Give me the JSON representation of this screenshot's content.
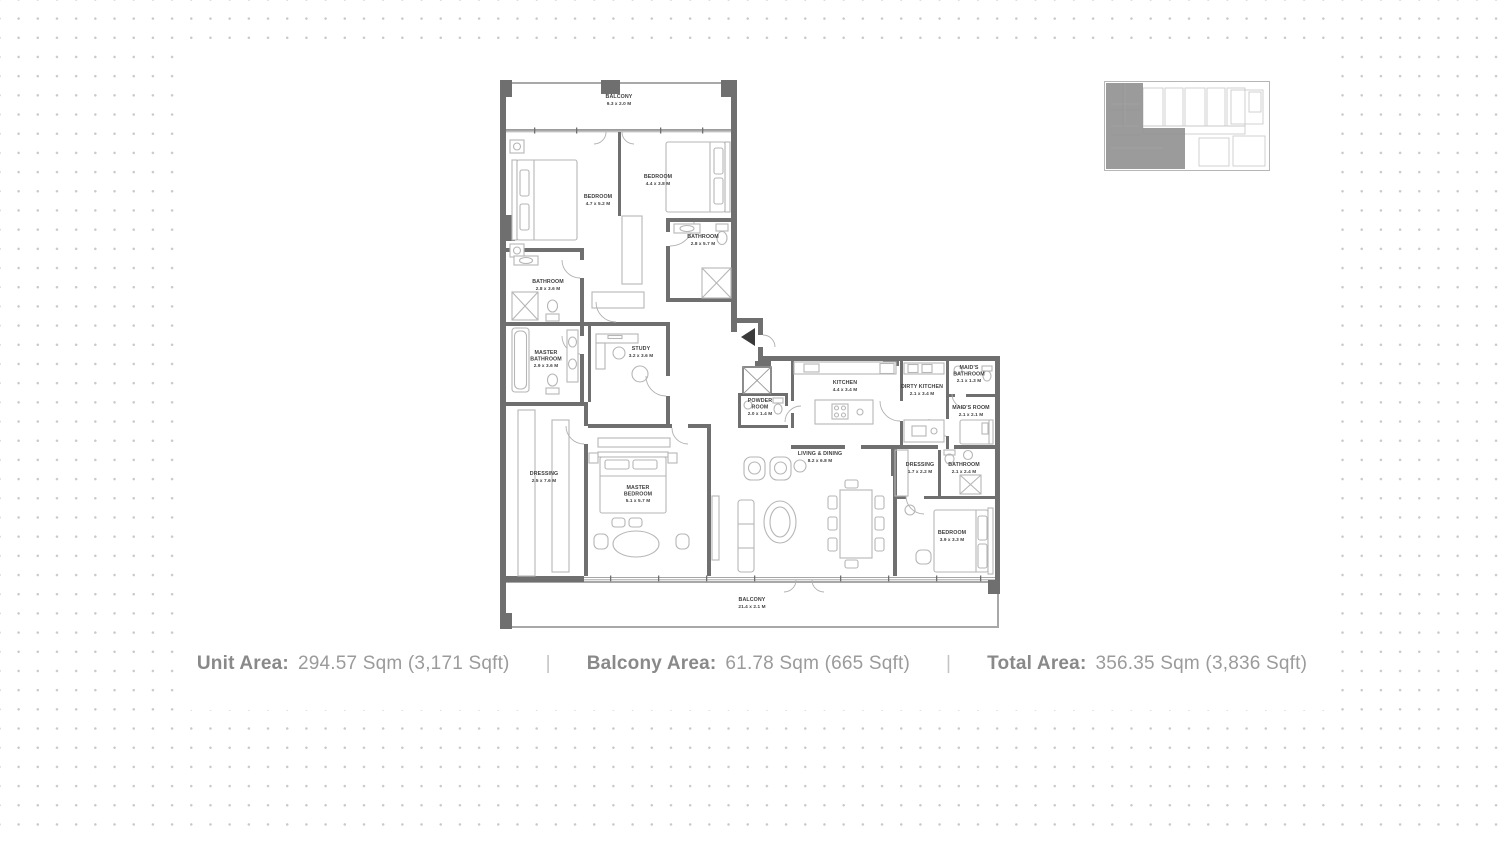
{
  "footer": {
    "separator": "|",
    "items": [
      {
        "label": "Unit Area:",
        "value": "294.57 Sqm (3,171 Sqft)"
      },
      {
        "label": "Balcony Area:",
        "value": "61.78 Sqm (665 Sqft)"
      },
      {
        "label": "Total Area:",
        "value": "356.35 Sqm (3,836 Sqft)"
      }
    ]
  },
  "plan": {
    "rooms": {
      "balcony_top": {
        "lines": [
          "BALCONY",
          "9.3 x 2.0 M"
        ]
      },
      "bedroom_1": {
        "lines": [
          "BEDROOM",
          "4.7 x 5.2 M"
        ]
      },
      "bedroom_2": {
        "lines": [
          "BEDROOM",
          "4.4 x 3.8 M"
        ]
      },
      "bathroom_2": {
        "lines": [
          "BATHROOM",
          "2.8 x 5.7 M"
        ]
      },
      "bathroom_1": {
        "lines": [
          "BATHROOM",
          "2.8 x 3.6 M"
        ]
      },
      "master_bathroom": {
        "lines": [
          "MASTER",
          "BATHROOM",
          "2.9 x 3.6 M"
        ]
      },
      "study": {
        "lines": [
          "STUDY",
          "3.2 x 3.6 M"
        ]
      },
      "powder_room": {
        "lines": [
          "POWDER",
          "ROOM",
          "2.0 x 1.4 M"
        ]
      },
      "kitchen": {
        "lines": [
          "KITCHEN",
          "4.4 x 3.4 M"
        ]
      },
      "dirty_kitchen": {
        "lines": [
          "DIRTY KITCHEN",
          "2.1 x 3.4 M"
        ]
      },
      "maids_bathroom": {
        "lines": [
          "MAID'S",
          "BATHROOM",
          "2.1 x 1.3 M"
        ]
      },
      "maids_room": {
        "lines": [
          "MAID'S ROOM",
          "2.1 x 2.1 M"
        ]
      },
      "living_dining": {
        "lines": [
          "LIVING & DINING",
          "8.2 x 6.8 M"
        ]
      },
      "dressing_master": {
        "lines": [
          "DRESSING",
          "2.5 x 7.6 M"
        ]
      },
      "master_bedroom": {
        "lines": [
          "MASTER",
          "BEDROOM",
          "5.1 x 5.7 M"
        ]
      },
      "dressing_2": {
        "lines": [
          "DRESSING",
          "1.7 x 2.2 M"
        ]
      },
      "bathroom_3": {
        "lines": [
          "BATHROOM",
          "2.1 x 2.4 M"
        ]
      },
      "bedroom_3": {
        "lines": [
          "BEDROOM",
          "3.9 x 3.3 M"
        ]
      },
      "balcony_bottom": {
        "lines": [
          "BALCONY",
          "21.4 x 2.1 M"
        ]
      }
    }
  },
  "colors": {
    "wall": "#6f6f6f",
    "balcony_wall": "#a8a8a8",
    "furniture_line": "#b6b6b6",
    "room_label": "#3f3f3f",
    "background_dot": "#c9c9c9",
    "footer_label": "#898989",
    "footer_value": "#9b9b9b",
    "separator": "#c3c3c3",
    "keyplan_highlight": "#909090"
  }
}
